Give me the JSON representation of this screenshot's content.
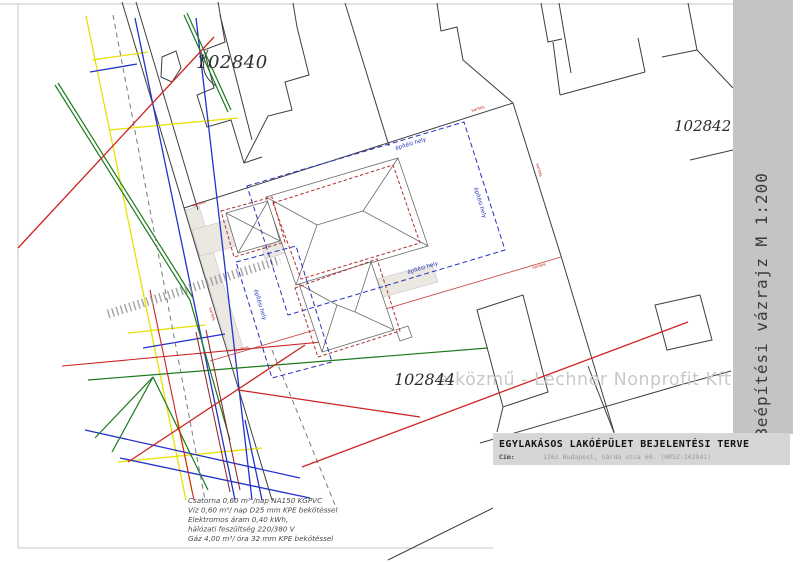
{
  "band": {
    "label": "Beépítési vázrajz M 1:200",
    "bg": "#c4c4c4"
  },
  "title_block": {
    "title": "EGYLAKÁSOS LAKÓÉPÜLET BEJELENTÉSI TERVE",
    "address_label": "Cím:",
    "address_value": "1163 Budapest, Gárda utca 60. (HRSZ:102841)",
    "bg": "#d6d6d6"
  },
  "parcel_labels": {
    "upper_left": "102840",
    "right": "102842",
    "lower": "102844"
  },
  "watermark": "e-közmű - Lechner Nonprofit Kft.",
  "map_labels": {
    "building_area": "építési hely",
    "boundary": "kerítés"
  },
  "notes": {
    "line1": "Csatorna 0,60 m³ /nap NA150 KGPVC",
    "line2": "Víz 0,60 m³/ nap D25 mm KPE bekötéssel",
    "line3": "Elektromos áram 0,40 kWh,",
    "line4": "hálózati feszültség 220/380 V",
    "line5": "Gáz 4,00 m³/ óra 32 mm KPE bekötéssel"
  },
  "colors": {
    "gas_yellow": "#e8e100",
    "water_blue": "#2233cc",
    "green_utility": "#1d7a1d",
    "electric_red": "#cc2222",
    "electric_maroon": "#8a2020",
    "telecom_gray_dashed": "#7a7a7a",
    "parcel_line": "#3f3f3f",
    "building_footprint_dash": "#b03030",
    "building_area_dash": "#2233bb",
    "sidewalk_beige": "#eae8e0",
    "band_bg": "#c4c4c4",
    "title_bg": "#d6d6d6"
  }
}
